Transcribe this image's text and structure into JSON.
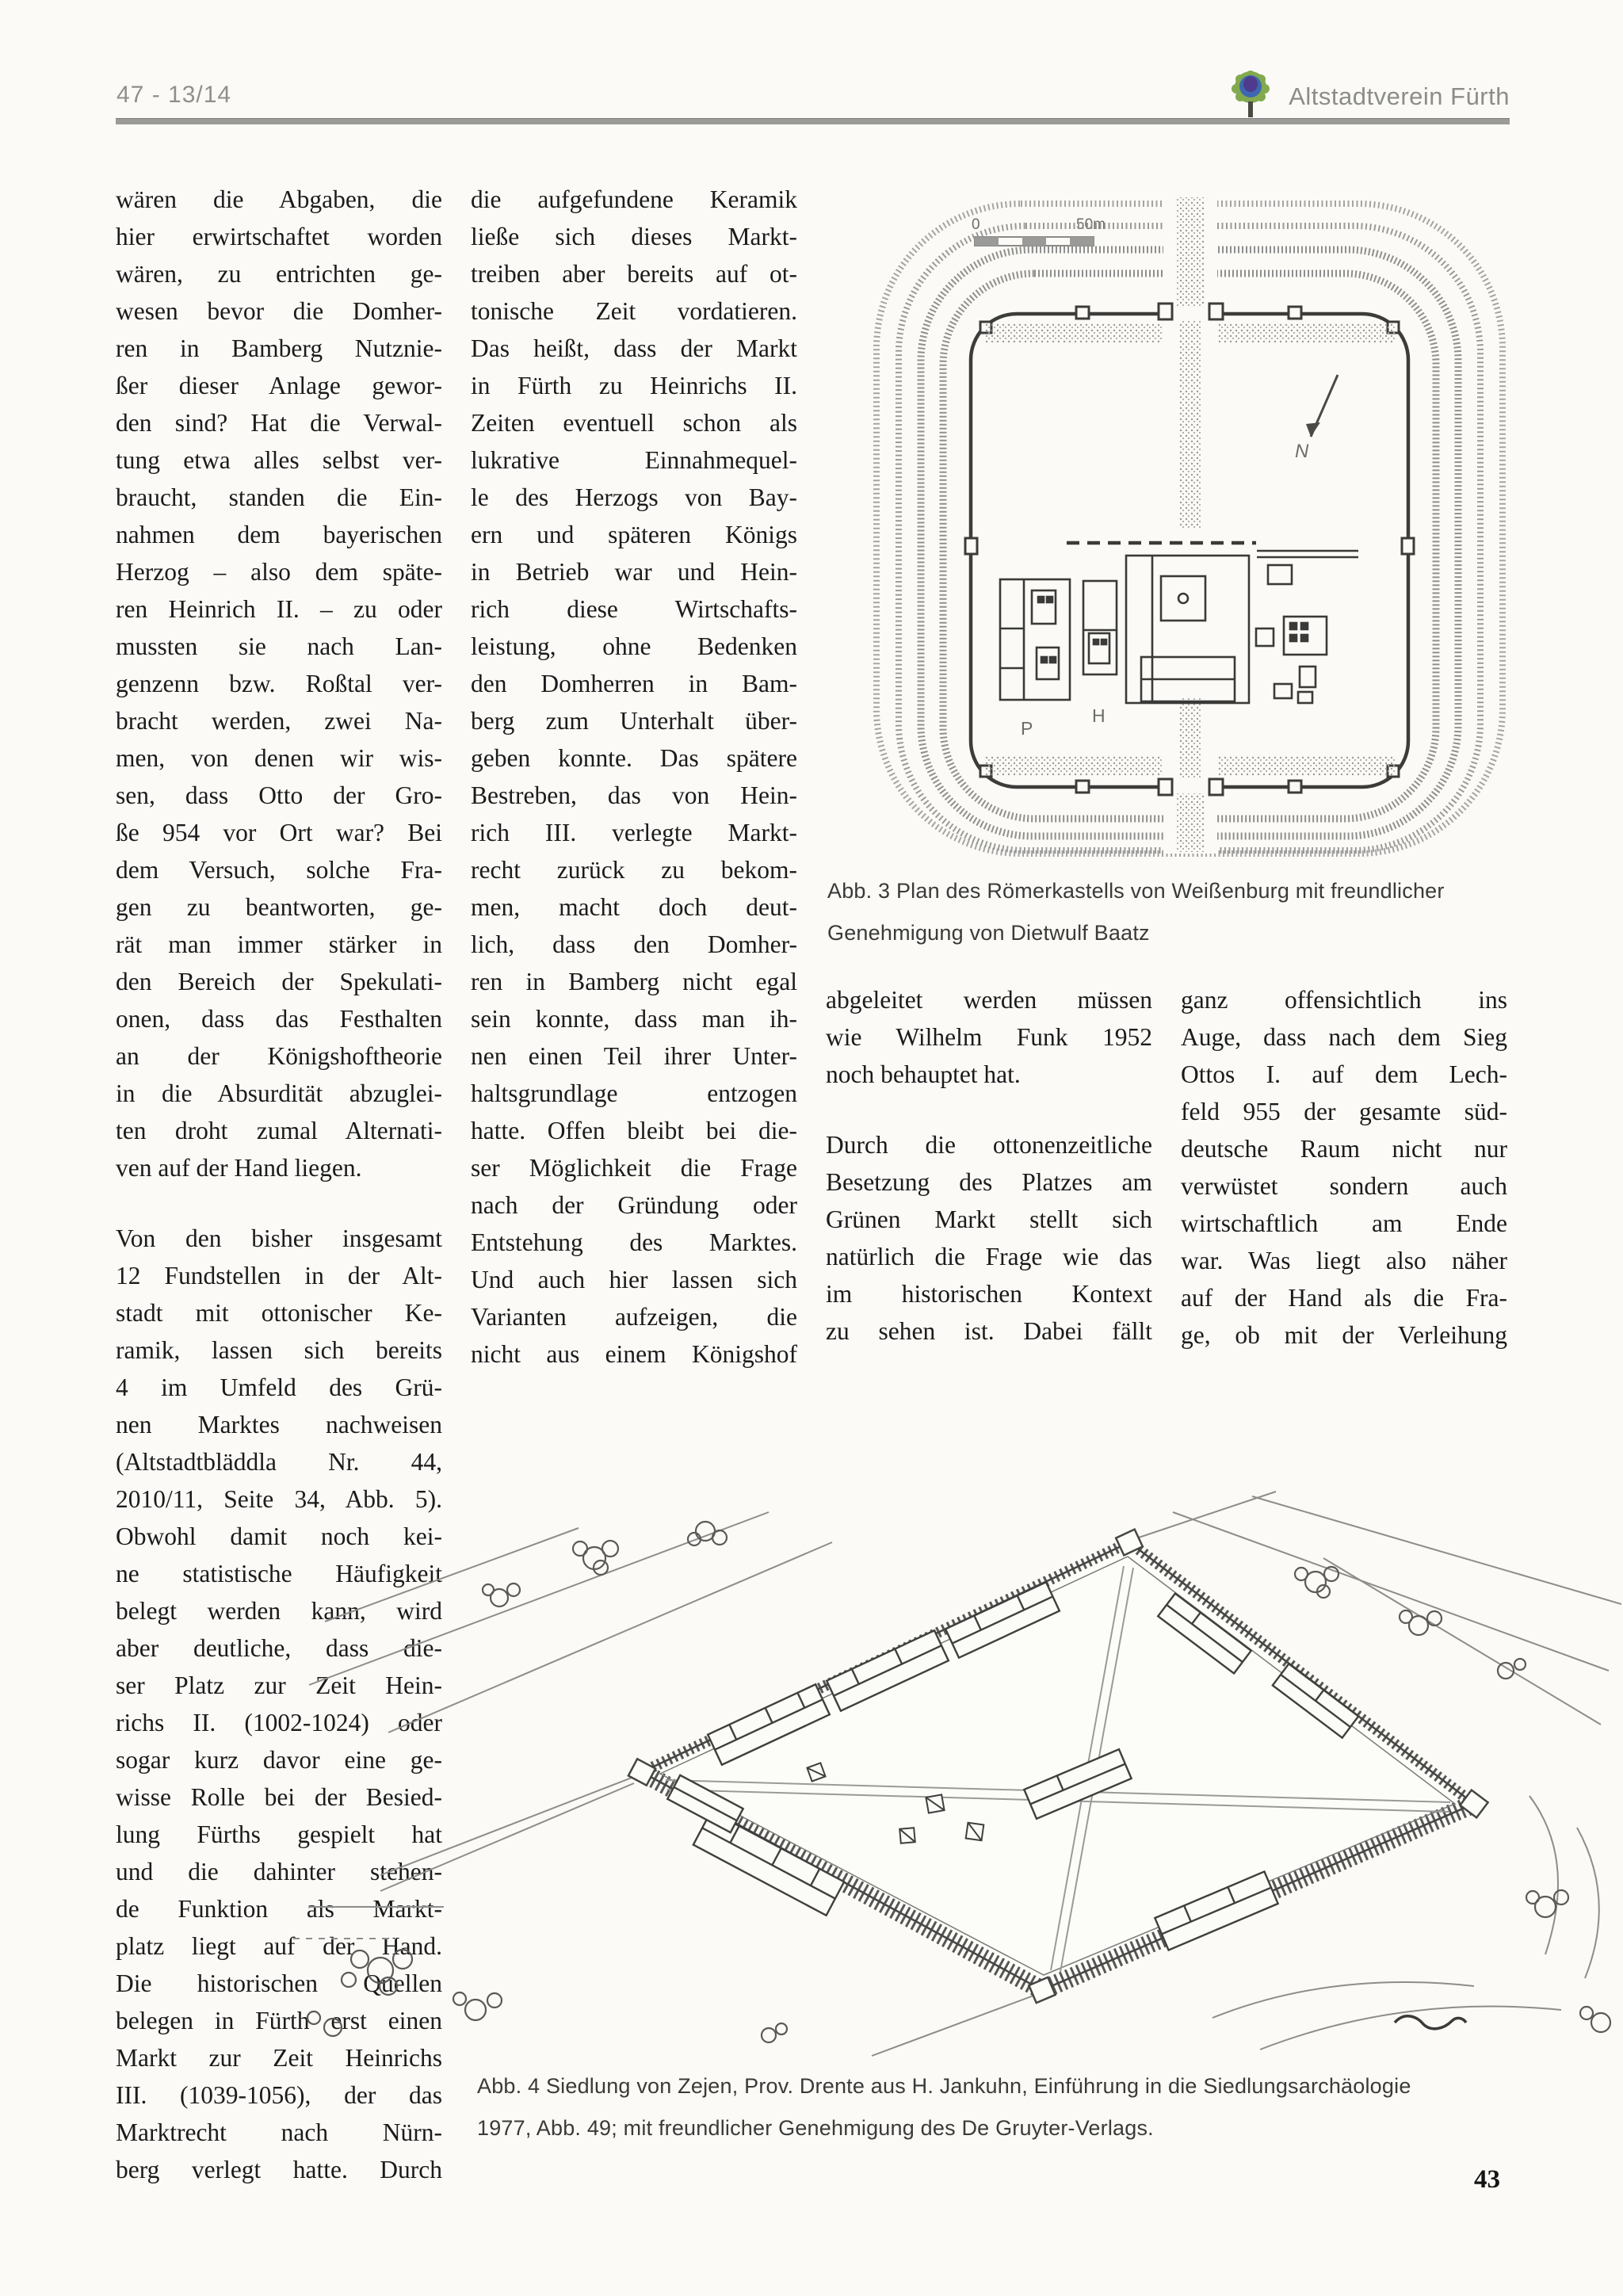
{
  "header": {
    "issue": "47 - 13/14",
    "brand": "Altstadtverein Fürth",
    "logo_colors": {
      "foliage": "#82a94e",
      "ring": "#3d68b0",
      "core": "#4e3b8e",
      "trunk": "#4a4a42"
    }
  },
  "columns": {
    "col1": [
      {
        "end": true,
        "lines": [
          "wären die Abgaben, die",
          "hier erwirtschaftet worden",
          "wären, zu entrichten ge-",
          "wesen bevor die Domher-",
          "ren in Bamberg Nutznie-",
          "ßer dieser Anlage gewor-",
          "den sind? Hat die Verwal-",
          "tung etwa alles selbst ver-",
          "braucht, standen die Ein-",
          "nahmen dem bayerischen",
          "Herzog – also dem späte-",
          "ren Heinrich II. – zu oder",
          "mussten sie nach Lan-",
          "genzenn bzw. Roßtal ver-",
          "bracht werden, zwei Na-",
          "men, von denen wir wis-",
          "sen, dass Otto der Gro-",
          "ße 954 vor Ort war? Bei",
          "dem Versuch, solche Fra-",
          "gen zu beantworten, ge-",
          "rät man immer stärker in",
          "den Bereich der Spekulati-",
          "onen, dass das Festhalten",
          "an der Königshoftheorie",
          "in die Absurdität abzuglei-",
          "ten droht zumal Alternati-",
          "ven auf der Hand liegen."
        ]
      },
      {
        "end": false,
        "lines": [
          "Von den bisher insgesamt",
          "12 Fundstellen in der Alt-",
          "stadt mit ottonischer Ke-",
          "ramik, lassen sich bereits",
          "4 im Umfeld des Grü-",
          "nen Marktes nachweisen",
          "(Altstadtbläddla Nr. 44,",
          "2010/11, Seite 34, Abb. 5).",
          "Obwohl damit noch kei-",
          "ne statistische Häufigkeit",
          "belegt werden kann, wird",
          "aber deutliche, dass die-",
          "ser Platz zur Zeit Hein-",
          "richs II. (1002-1024) oder",
          "sogar kurz davor eine ge-",
          "wisse Rolle bei der Besied-",
          "lung Fürths gespielt hat",
          "und die dahinter stehen-",
          "de Funktion als Markt-",
          "platz liegt auf der Hand.",
          "Die historischen Quellen",
          "belegen in Fürth erst einen",
          "Markt zur Zeit Heinrichs",
          "III. (1039-1056), der das",
          "Marktrecht nach Nürn-",
          "berg verlegt hatte. Durch"
        ]
      }
    ],
    "col2": [
      {
        "end": false,
        "lines": [
          "die aufgefundene Keramik",
          "ließe sich dieses Markt-",
          "treiben aber bereits auf ot-",
          "tonische Zeit vordatieren.",
          "Das heißt, dass der Markt",
          "in Fürth zu Heinrichs II.",
          "Zeiten eventuell schon als",
          "lukrative Einnahmequel-",
          "le des Herzogs von Bay-",
          "ern und späteren Königs",
          "in Betrieb war und Hein-",
          "rich diese Wirtschafts-",
          "leistung, ohne Bedenken",
          "den Domherren in Bam-",
          "berg zum Unterhalt über-",
          "geben konnte. Das spätere",
          "Bestreben, das von Hein-",
          "rich III. verlegte Markt-",
          "recht zurück zu bekom-",
          "men, macht doch deut-",
          "lich, dass den Domher-",
          "ren in Bamberg nicht egal",
          "sein konnte, dass man ih-",
          "nen einen Teil ihrer Unter-",
          "haltsgrundlage entzogen",
          "hatte. Offen bleibt bei die-",
          "ser Möglichkeit die Frage",
          "nach der Gründung oder",
          "Entstehung des Marktes.",
          "Und auch hier lassen sich",
          "Varianten aufzeigen, die",
          "nicht aus einem Königshof"
        ]
      }
    ],
    "col3": [
      {
        "end": true,
        "lines": [
          "abgeleitet werden müssen",
          "wie Wilhelm Funk 1952",
          "noch behauptet hat."
        ]
      },
      {
        "end": false,
        "lines": [
          "Durch die ottonenzeitliche",
          "Besetzung des Platzes am",
          "Grünen Markt stellt sich",
          "natürlich die Frage wie das",
          "im historischen Kontext",
          "zu sehen ist. Dabei fällt"
        ]
      }
    ],
    "col4": [
      {
        "end": false,
        "lines": [
          "ganz offensichtlich ins",
          "Auge, dass nach dem Sieg",
          "Ottos I. auf dem Lech-",
          "feld 955 der gesamte süd-",
          "deutsche Raum nicht nur",
          "verwüstet sondern auch",
          "wirtschaftlich am Ende",
          "war. Was liegt also näher",
          "auf der Hand als die Fra-",
          "ge, ob mit der Verleihung"
        ]
      }
    ]
  },
  "figures": {
    "kastell": {
      "caption_line1": "Abb. 3 Plan des Römerkastells von Weißenburg mit freundlicher",
      "caption_line2": "Genehmigung von Dietwulf Baatz",
      "scale_zero": "0",
      "scale_label": "50m",
      "letter_p": "P",
      "letter_h": "H",
      "north_label": "N"
    },
    "siedlung": {
      "caption_line1": "Abb. 4 Siedlung von Zejen, Prov. Drente aus H. Jankuhn, Einführung in die Siedlungsarchäologie",
      "caption_line2": "1977, Abb. 49; mit freundlicher Genehmigung des De Gruyter-Verlags."
    }
  },
  "page": {
    "number": "43"
  }
}
